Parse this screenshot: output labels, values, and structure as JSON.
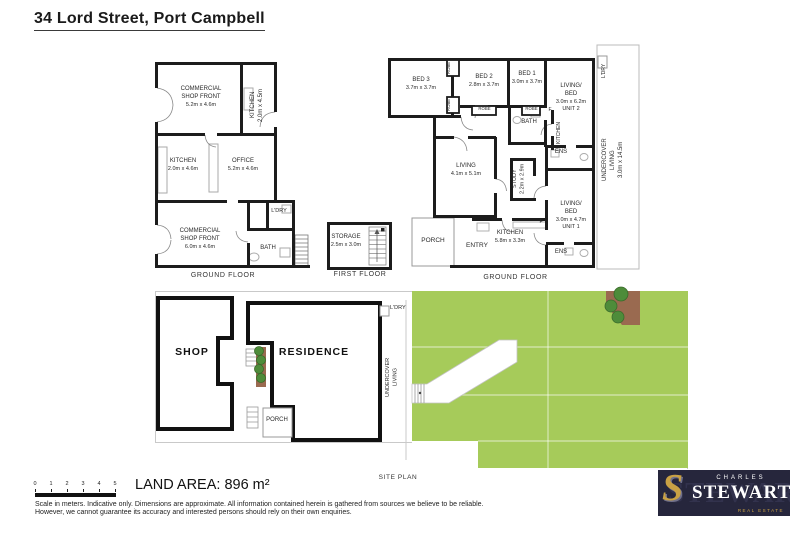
{
  "title": "34 Lord Street, Port Campbell",
  "shop_plan": {
    "floor_label": "GROUND FLOOR",
    "rooms": {
      "shop_front_top": {
        "name": "COMMERCIAL\nSHOP FRONT",
        "dims": "5.2m x 4.6m"
      },
      "kitchen_top": {
        "name": "KITCHEN\n2.0m x 4.5m"
      },
      "kitchen_mid": {
        "name": "KITCHEN",
        "dims": "2.0m x 4.6m"
      },
      "office": {
        "name": "OFFICE",
        "dims": "5.2m x 4.6m"
      },
      "ldry": {
        "name": "L'DRY"
      },
      "shop_front_bottom": {
        "name": "COMMERCIAL\nSHOP FRONT",
        "dims": "6.0m x 4.6m"
      },
      "bath": {
        "name": "BATH"
      }
    }
  },
  "first_floor_plan": {
    "floor_label": "FIRST FLOOR",
    "storage": {
      "name": "STORAGE",
      "dims": "2.5m x 3.0m"
    }
  },
  "residence_plan": {
    "floor_label": "GROUND FLOOR",
    "rooms": {
      "bed3": {
        "name": "BED 3",
        "dims": "3.7m x 3.7m"
      },
      "robe_a": {
        "name": "ROBE"
      },
      "robe_b": {
        "name": "ROBE"
      },
      "robe_c": {
        "name": "ROBE"
      },
      "robe_d": {
        "name": "ROBE"
      },
      "bed2": {
        "name": "BED 2",
        "dims": "2.8m x 3.7m"
      },
      "bed1": {
        "name": "BED 1",
        "dims": "3.0m x 3.7m"
      },
      "unit2": {
        "name": "LIVING/\nBED",
        "dims": "3.0m x 6.2m",
        "unit": "UNIT 2"
      },
      "ldry": {
        "name": "L'DRY"
      },
      "bath": {
        "name": "BATH"
      },
      "fridge_a": {
        "name": "F"
      },
      "fridge_b": {
        "name": "F"
      },
      "kitchen_small": {
        "name": "KITCHEN"
      },
      "living": {
        "name": "LIVING",
        "dims": "4.1m x 5.1m"
      },
      "study": {
        "name": "STUDY\n2.2m x 2.9m"
      },
      "ens_a": {
        "name": "ENS"
      },
      "ens_b": {
        "name": "ENS"
      },
      "unit1": {
        "name": "LIVING/\nBED",
        "dims": "3.0m x 4.7m",
        "unit": "UNIT 1"
      },
      "undercover": {
        "name": "UNDERCOVER\nLIVING\n3.0m x 14.5m"
      },
      "porch": {
        "name": "PORCH"
      },
      "entry": {
        "name": "ENTRY"
      },
      "kitchen_main": {
        "name": "KITCHEN",
        "dims": "5.8m x 3.3m"
      }
    }
  },
  "site_plan": {
    "label": "SITE PLAN",
    "shop": "SHOP",
    "residence": "RESIDENCE",
    "porch": "PORCH",
    "ldry": "L'DRY",
    "undercover": "UNDERCOVER\nLIVING"
  },
  "footer": {
    "land_area": "LAND AREA: 896 m²",
    "scale_ticks": [
      "0",
      "1",
      "2",
      "3",
      "4",
      "5"
    ],
    "disclaimer_line1": "Scale in meters. Indicative only. Dimensions are approximate. All information contained herein is gathered from sources we believe to be reliable.",
    "disclaimer_line2": "However, we cannot guarantee its accuracy and interested persons should rely on their own enquiries."
  },
  "logo": {
    "top": "CHARLES",
    "main": "STEWART",
    "sub": "REAL ESTATE",
    "monogram": "S"
  },
  "colors": {
    "lawn": "#a6cb5a",
    "garden-bed": "#9a6a50",
    "tree": "#4e8c3a",
    "wall": "#1c1c1c",
    "navy": "#26263c",
    "gold": "#c9a144"
  }
}
